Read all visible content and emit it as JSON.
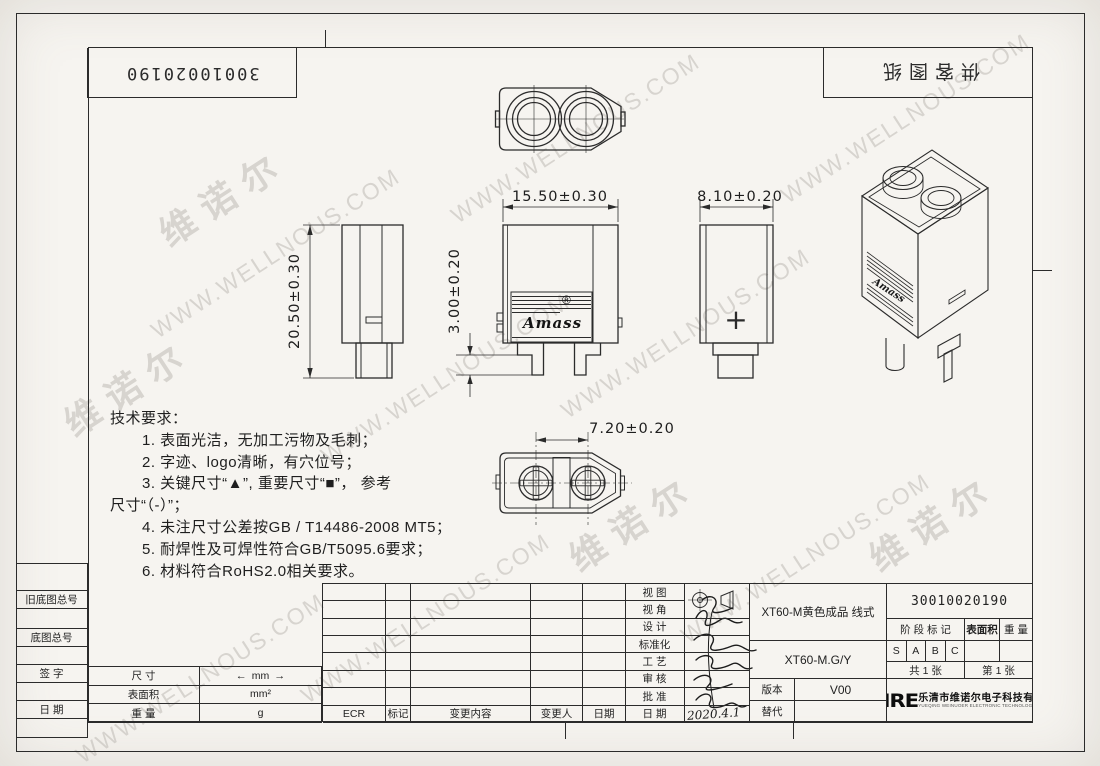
{
  "page": {
    "doc_type": "engineering-drawing",
    "bg_color": "#f6f4f0",
    "line_color": "#2b2b2b"
  },
  "corner": {
    "top_left_number": "30010020190",
    "top_right_label": "供客图纸"
  },
  "watermarks": {
    "brand": "维诺尔",
    "url": "WWW.WELLNOUS.COM"
  },
  "tech_requirements": {
    "lines": [
      "技术要求：",
      "1. 表面光洁，无加工污物及毛刺；",
      "2. 字迹、logo清晰，有穴位号；",
      "3. 关键尺寸“▲”, 重要尺寸“■”， 参考",
      "尺寸“（-）”；",
      "4. 未注尺寸公差按GB / T14486-2008 MT5；",
      "5. 耐焊性及可焊性符合GB/T5095.6要求；",
      "6. 材料符合RoHS2.0相关要求。"
    ]
  },
  "dimensions": {
    "body_width": "15.50±0.30",
    "body_depth": "8.10±0.20",
    "body_height": "20.50±0.30",
    "pin_length": "3.00±0.20",
    "pin_pitch": "7.20±0.20"
  },
  "drawing_labels": {
    "amass_logo": "Amass",
    "registered": "®",
    "polarity_mark": "+"
  },
  "title_block": {
    "left_labels": [
      "旧底图总号",
      "底图总号",
      "签  字",
      "日  期"
    ],
    "units_table": {
      "rows": [
        [
          "尺  寸",
          "mm"
        ],
        [
          "表面积",
          "mm²"
        ],
        [
          "重  量",
          "g"
        ]
      ]
    },
    "revision_footer": [
      "ECR",
      "标记",
      "变更内容",
      "变更人",
      "日期"
    ],
    "approval_labels": [
      "视  图",
      "视  角",
      "设  计",
      "标准化",
      "工  艺",
      "审  核",
      "批  准",
      "日  期"
    ],
    "product_name": "XT60-M黄色成品 线式",
    "drawing_no": "30010020190",
    "stage_label": "阶 段 标 记",
    "surface_area_label": "表面积",
    "weight_label": "重 量",
    "stages": [
      "S",
      "A",
      "B",
      "C"
    ],
    "sheet_total": "共  1  张",
    "sheet_no": "第  1  张",
    "model": "XT60-M.G/Y",
    "version_label": "版本",
    "version_value": "V00",
    "replace_label": "替代",
    "handwritten_date": "2020.4.1",
    "company_logo": "WNRE",
    "company_cn": "乐清市维诺尔电子科技有限公司",
    "company_en": "YUEQING WEINUOER ELECTRONIC TECHNOLOGY CO.,LTD."
  }
}
